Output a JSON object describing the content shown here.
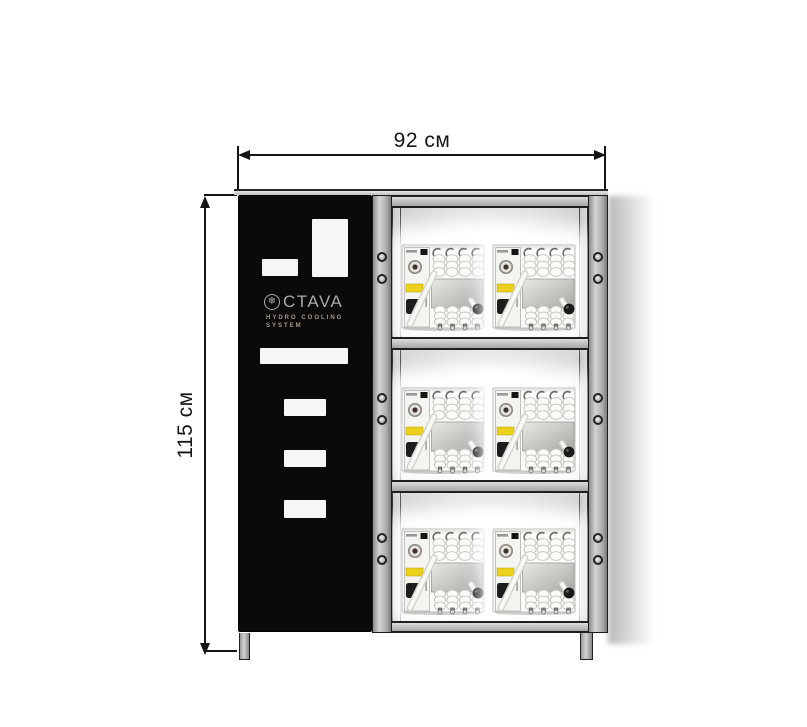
{
  "diagram": {
    "type": "product dimension drawing",
    "subject": "hydro cooling cabinet with rack of coiled-hose cooling units"
  },
  "dimensions": {
    "width_label": "92 см",
    "height_label": "115 см"
  },
  "brand": {
    "name": "CTAVA",
    "logo_icon": "snowflake-in-circle",
    "logo_glyph": "❄",
    "subtitle_line1": "HYDRO COOLING",
    "subtitle_line2": "SYSTEM"
  },
  "rack": {
    "shelves": 3,
    "units_per_shelf": 2
  },
  "colors": {
    "frame_gray": "#b7b7b7",
    "panel_black": "#0a0a0a",
    "dimension_line": "#141414",
    "unit_label_yellow": "#ecd11c"
  }
}
